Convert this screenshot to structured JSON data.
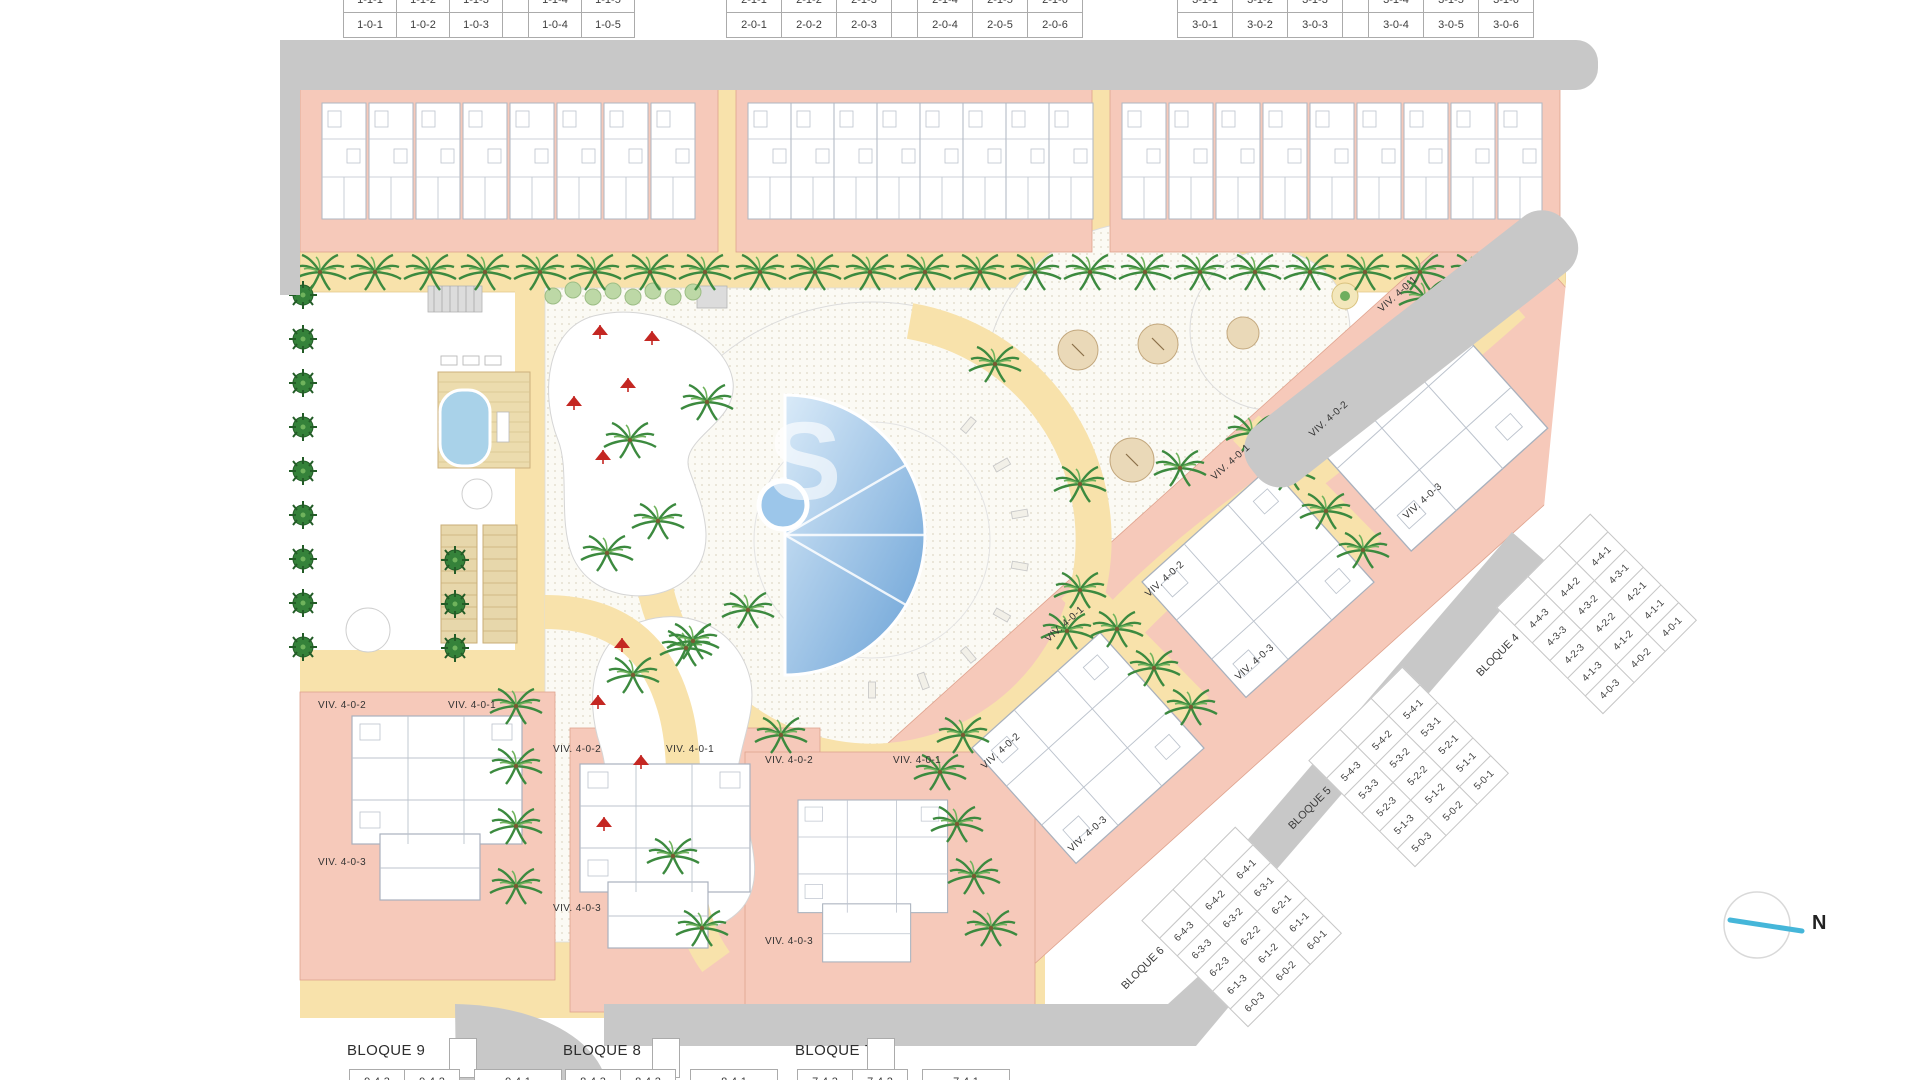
{
  "top_tables": [
    {
      "rows": [
        [
          "1-1-1",
          "1-1-2",
          "1-1-3",
          "",
          "1-1-4",
          "1-1-5"
        ],
        [
          "1-0-1",
          "1-0-2",
          "1-0-3",
          "",
          "1-0-4",
          "1-0-5"
        ]
      ]
    },
    {
      "rows": [
        [
          "2-1-1",
          "2-1-2",
          "2-1-3",
          "",
          "2-1-4",
          "2-1-5",
          "2-1-6"
        ],
        [
          "2-0-1",
          "2-0-2",
          "2-0-3",
          "",
          "2-0-4",
          "2-0-5",
          "2-0-6"
        ]
      ]
    },
    {
      "rows": [
        [
          "3-1-1",
          "3-1-2",
          "3-1-3",
          "",
          "3-1-4",
          "3-1-5",
          "3-1-6"
        ],
        [
          "3-0-1",
          "3-0-2",
          "3-0-3",
          "",
          "3-0-4",
          "3-0-5",
          "3-0-6"
        ]
      ]
    }
  ],
  "rot_tables": [
    {
      "name": "BLOQUE 4",
      "rows": [
        [
          "",
          "",
          ""
        ],
        [
          "4-4-3",
          "4-4-2",
          "4-4-1"
        ],
        [
          "4-3-3",
          "4-3-2",
          "4-3-1"
        ],
        [
          "4-2-3",
          "4-2-2",
          "4-2-1"
        ],
        [
          "4-1-3",
          "4-1-2",
          "4-1-1"
        ],
        [
          "4-0-3",
          "4-0-2",
          "4-0-1"
        ]
      ]
    },
    {
      "name": "BLOQUE 5",
      "rows": [
        [
          "",
          "",
          ""
        ],
        [
          "5-4-3",
          "5-4-2",
          "5-4-1"
        ],
        [
          "5-3-3",
          "5-3-2",
          "5-3-1"
        ],
        [
          "5-2-3",
          "5-2-2",
          "5-2-1"
        ],
        [
          "5-1-3",
          "5-1-2",
          "5-1-1"
        ],
        [
          "5-0-3",
          "5-0-2",
          "5-0-1"
        ]
      ]
    },
    {
      "name": "BLOQUE 6",
      "rows": [
        [
          "",
          "",
          ""
        ],
        [
          "6-4-3",
          "6-4-2",
          "6-4-1"
        ],
        [
          "6-3-3",
          "6-3-2",
          "6-3-1"
        ],
        [
          "6-2-3",
          "6-2-2",
          "6-2-1"
        ],
        [
          "6-1-3",
          "6-1-2",
          "6-1-1"
        ],
        [
          "6-0-3",
          "6-0-2",
          "6-0-1"
        ]
      ]
    }
  ],
  "bottom_tables": [
    {
      "name": "BLOQUE 9",
      "rows": [
        [
          "9-4-3",
          "9-4-2",
          "",
          "9-4-1"
        ]
      ]
    },
    {
      "name": "BLOQUE 8",
      "rows": [
        [
          "8-4-3",
          "8-4-2",
          "",
          "8-4-1"
        ]
      ]
    },
    {
      "name": "BLOQUE 7",
      "rows": [
        [
          "7-4-3",
          "7-4-2",
          "",
          "7-4-1"
        ]
      ]
    }
  ],
  "unit_labels": [
    {
      "text": "VIV. 4-0-2",
      "x": 318,
      "y": 700,
      "rot": 0
    },
    {
      "text": "VIV. 4-0-1",
      "x": 448,
      "y": 700,
      "rot": 0
    },
    {
      "text": "VIV. 4-0-3",
      "x": 318,
      "y": 857,
      "rot": 0
    },
    {
      "text": "VIV. 4-0-2",
      "x": 553,
      "y": 744,
      "rot": 0
    },
    {
      "text": "VIV. 4-0-1",
      "x": 666,
      "y": 744,
      "rot": 0
    },
    {
      "text": "VIV. 4-0-3",
      "x": 553,
      "y": 903,
      "rot": 0
    },
    {
      "text": "VIV. 4-0-2",
      "x": 765,
      "y": 755,
      "rot": 0
    },
    {
      "text": "VIV. 4-0-1",
      "x": 893,
      "y": 755,
      "rot": 0
    },
    {
      "text": "VIV. 4-0-3",
      "x": 765,
      "y": 936,
      "rot": 0
    },
    {
      "text": "VIV. 4-0-1",
      "x": 1047,
      "y": 635,
      "rot": -42
    },
    {
      "text": "VIV. 4-0-2",
      "x": 983,
      "y": 762,
      "rot": -42
    },
    {
      "text": "VIV. 4-0-3",
      "x": 1070,
      "y": 845,
      "rot": -42
    },
    {
      "text": "VIV. 4-0-1",
      "x": 1213,
      "y": 473,
      "rot": -42
    },
    {
      "text": "VIV. 4-0-2",
      "x": 1147,
      "y": 590,
      "rot": -42
    },
    {
      "text": "VIV. 4-0-3",
      "x": 1237,
      "y": 673,
      "rot": -42
    },
    {
      "text": "VIV. 4-0-1",
      "x": 1380,
      "y": 305,
      "rot": -42
    },
    {
      "text": "VIV. 4-0-2",
      "x": 1311,
      "y": 430,
      "rot": -42
    },
    {
      "text": "VIV. 4-0-3",
      "x": 1405,
      "y": 512,
      "rot": -42
    }
  ],
  "north": {
    "label": "N"
  },
  "watermark": {
    "text": "S"
  },
  "colors": {
    "road_gray": "#c8c8c8",
    "building_pink": "#f6c9ba",
    "path_yellow": "#f8e2ab",
    "pool_blue": "#69a1d6",
    "palm_green": "#3c8a3f",
    "umbrella_red": "#c42722",
    "north_line": "#45b6d9"
  }
}
